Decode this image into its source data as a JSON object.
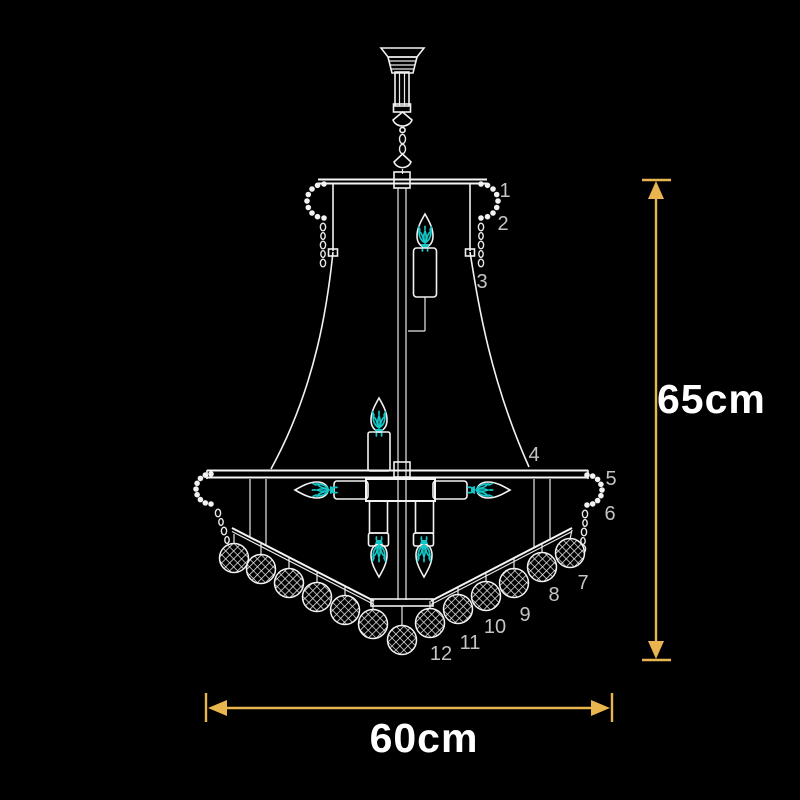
{
  "page": {
    "background_color": "#000000"
  },
  "drawing": {
    "subject": "chandelier dimension diagram",
    "line_color": "#f2f2f2",
    "flame_color": "#14c6c6",
    "dimension_color": "#e9b54e",
    "part_label_color": "#c4c4c4",
    "text_color": "#ffffff"
  },
  "dimensions": {
    "height": "65cm",
    "width": "60cm"
  },
  "part_labels": [
    "1",
    "2",
    "3",
    "4",
    "5",
    "6",
    "7",
    "8",
    "9",
    "10",
    "11",
    "12"
  ],
  "icons": {
    "flame_icon": "cyan-filament-burst",
    "crystal_ball_icon": "lattice-mesh-sphere",
    "bead_chain_icon": "oval-link-chain",
    "arrow_up_icon": "solid-triangle-up",
    "arrow_down_icon": "solid-triangle-down",
    "arrow_left_icon": "solid-triangle-left",
    "arrow_right_icon": "solid-triangle-right"
  }
}
